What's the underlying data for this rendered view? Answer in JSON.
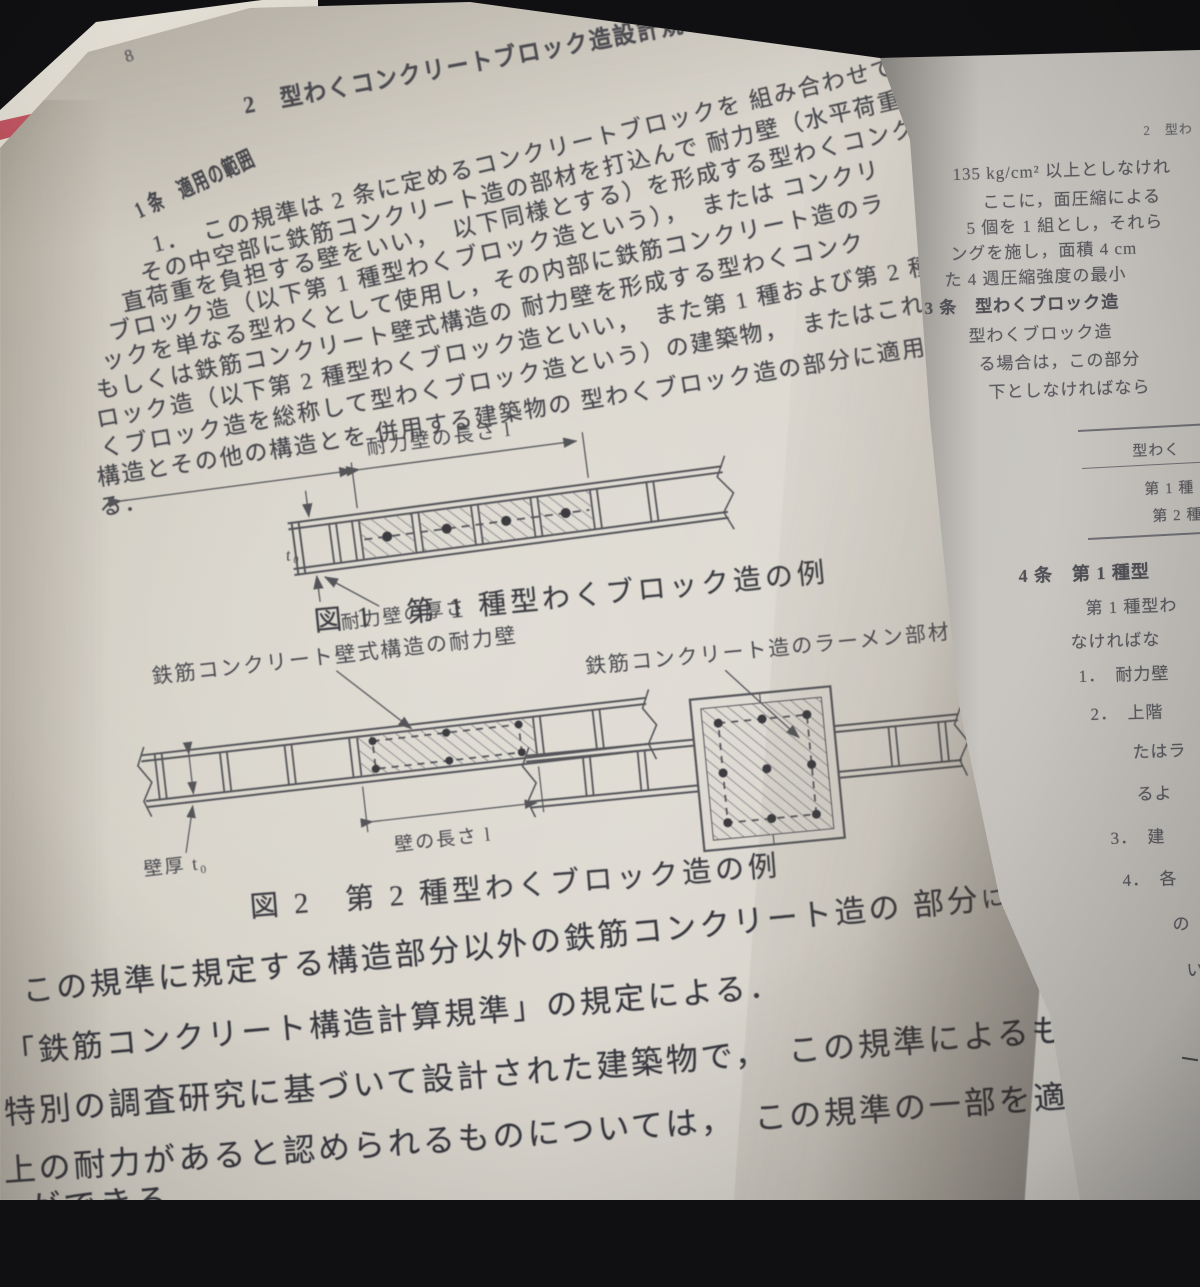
{
  "colors": {
    "background": "#101012",
    "left_page": "#d6d2c8",
    "right_page": "#c7c4bf",
    "cover_edge_red": "#b2434f",
    "ink": "#46464c"
  },
  "left_page": {
    "page_number": "8",
    "header": "2　型わくコンクリートブロック造設計規準（1964）",
    "article": {
      "heading": "1 条　適用の範囲",
      "lines": [
        "1．　この規準は 2 条に定めるコンクリートブロックを 組み合わせて型わ",
        "その中空部に鉄筋コンクリート造の部材を打込んで 耐力壁（水平荷重お",
        "直荷重を負担する壁をいい，　以下同様とする）を形成する型わくコンク",
        "ブロック造（以下第 1 種型わくブロック造という），　または コンクリ",
        "ックを単なる型わくとして使用し，その内部に鉄筋コンクリート造のラ",
        "もしくは鉄筋コンクリート壁式構造の 耐力壁を形成する型わくコンク",
        "ロック造（以下第 2 種型わくブロック造といい，　また第 1 種および第 2 種",
        "くブロック造を総称して型わくブロック造という）の建築物，　またはこれら",
        "構造とその他の構造とを 併用する建築物の 型わくブロック造の部分に適用",
        "る．"
      ]
    },
    "fig1": {
      "length_label": "耐力壁の長さ l",
      "t0_label": "t₀",
      "thickness_label": "耐力壁の厚さ",
      "caption": "図 1　第 1 種型わくブロック造の例"
    },
    "fig2": {
      "left_label": "鉄筋コンクリート壁式構造の耐力壁",
      "right_label": "鉄筋コンクリート造のラーメン部材",
      "wall_thickness_label": "壁厚 t₀",
      "wall_length_label": "壁の長さ l",
      "caption": "図 2　第 2 種型わくブロック造の例"
    },
    "closing": {
      "p1a": "この規準に規定する構造部分以外の鉄筋コンクリート造の 部分",
      "p1b": "については，",
      "p2": "「鉄筋コンクリート構造計算規準」の規定による．",
      "p3a": "特別の調査研究に基づいて設計された建築物で，　この規準によるものと",
      "p3b": "同等",
      "p4": "上の耐力があると認められるものについては，　この規準の一部を適用しない",
      "p5": "ができる"
    }
  },
  "right_page": {
    "header_fragment": "2　型わ",
    "lines": [
      "135 kg/cm² 以上としなけれ",
      "ここに，面圧縮による",
      "5 個を 1 組とし，それら",
      "ングを施し，面積 4 cm",
      "た 4 週圧縮強度の最小",
      "3 条　型わくブロック造",
      "型わくブロック造",
      "る場合は，この部分",
      "下としなければなら"
    ],
    "table": {
      "header": "型わく",
      "row1": "第 1 種",
      "row2": "第 2 種"
    },
    "lower_lines": [
      "4 条　第 1 種型",
      "第 1 種型わ",
      "なければな",
      "1．　耐力壁",
      "2．　上階",
      "たはラ",
      "るよ",
      "3．　建",
      "4．　各",
      "の",
      "い"
    ]
  }
}
